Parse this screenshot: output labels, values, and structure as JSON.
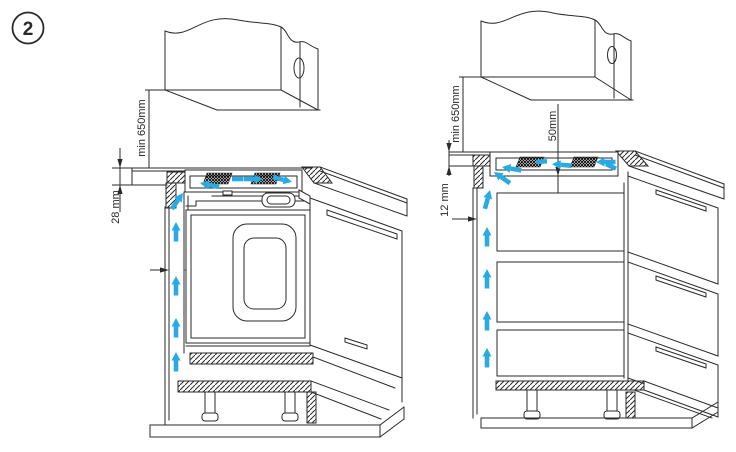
{
  "figure": {
    "badge": "2"
  },
  "colors": {
    "line": "#2b2a29",
    "airflow_arrow": "#29abe2"
  },
  "left_diagram": {
    "unit": "hob-above-built-in-oven",
    "labels": {
      "min_height_above": "min 650mm",
      "worktop_thickness": "28 mm",
      "side_gap": "30mm"
    }
  },
  "right_diagram": {
    "unit": "hob-above-drawers",
    "labels": {
      "min_height_above": "min 650mm",
      "worktop_thickness": "12 mm",
      "side_gap": "30mm",
      "clearance_below_hob": "50mm"
    }
  }
}
